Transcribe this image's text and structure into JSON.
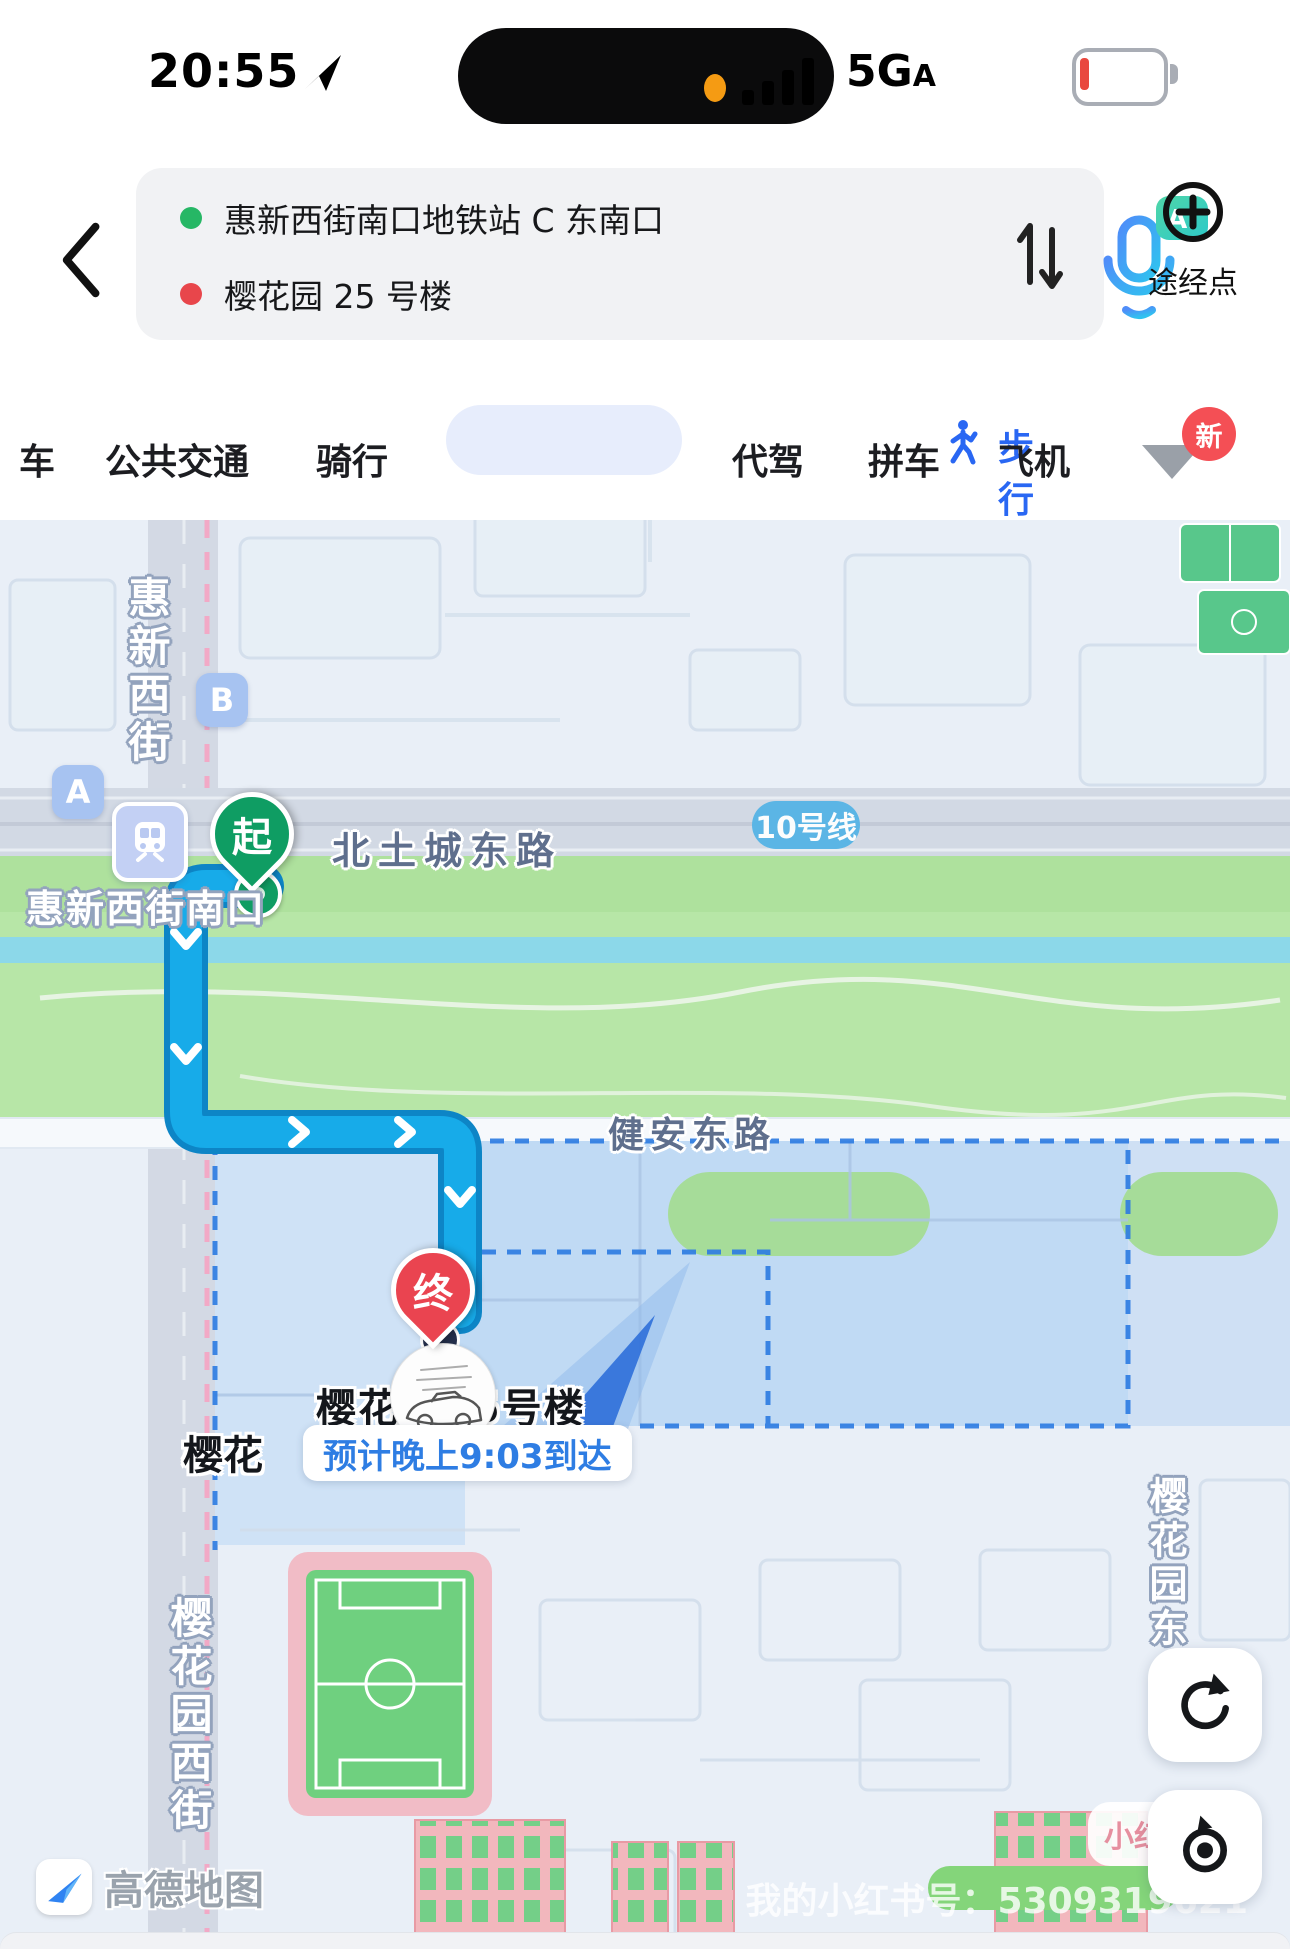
{
  "status_bar": {
    "time": "20:55",
    "network": "5G",
    "network_suffix": "A"
  },
  "route_panel": {
    "origin": "惠新西街南口地铁站 C 东南口",
    "destination": "樱花园 25 号楼",
    "ai_badge": "AI",
    "waypoint_label": "途经点"
  },
  "mode_tabs": {
    "items": [
      {
        "label": "车"
      },
      {
        "label": "公共交通"
      },
      {
        "label": "骑行"
      },
      {
        "label": "步行"
      },
      {
        "label": "代驾"
      },
      {
        "label": "拼车"
      },
      {
        "label": "飞机"
      }
    ],
    "new_badge": "新"
  },
  "map": {
    "markers": {
      "start": "起",
      "end": "终",
      "exit_a": "A",
      "exit_b": "B"
    },
    "labels": {
      "huixin_west_street": "惠新西街",
      "station_name": "惠新西街南口",
      "north_tucheng_east_road": "北土城东路",
      "line_10": "10号线",
      "jianan_east_road": "健安东路",
      "yinghua_partial": "樱花",
      "destination": "樱花园25号楼",
      "eta": "预计晚上9:03到达",
      "yinghuayuan_west_street": "樱花园西街",
      "yinghuayuan_east": "樱花园东"
    },
    "attribution": "高德地图",
    "watermark": "我的小红书号：5309319621",
    "xiaohongshu": "小红书"
  }
}
